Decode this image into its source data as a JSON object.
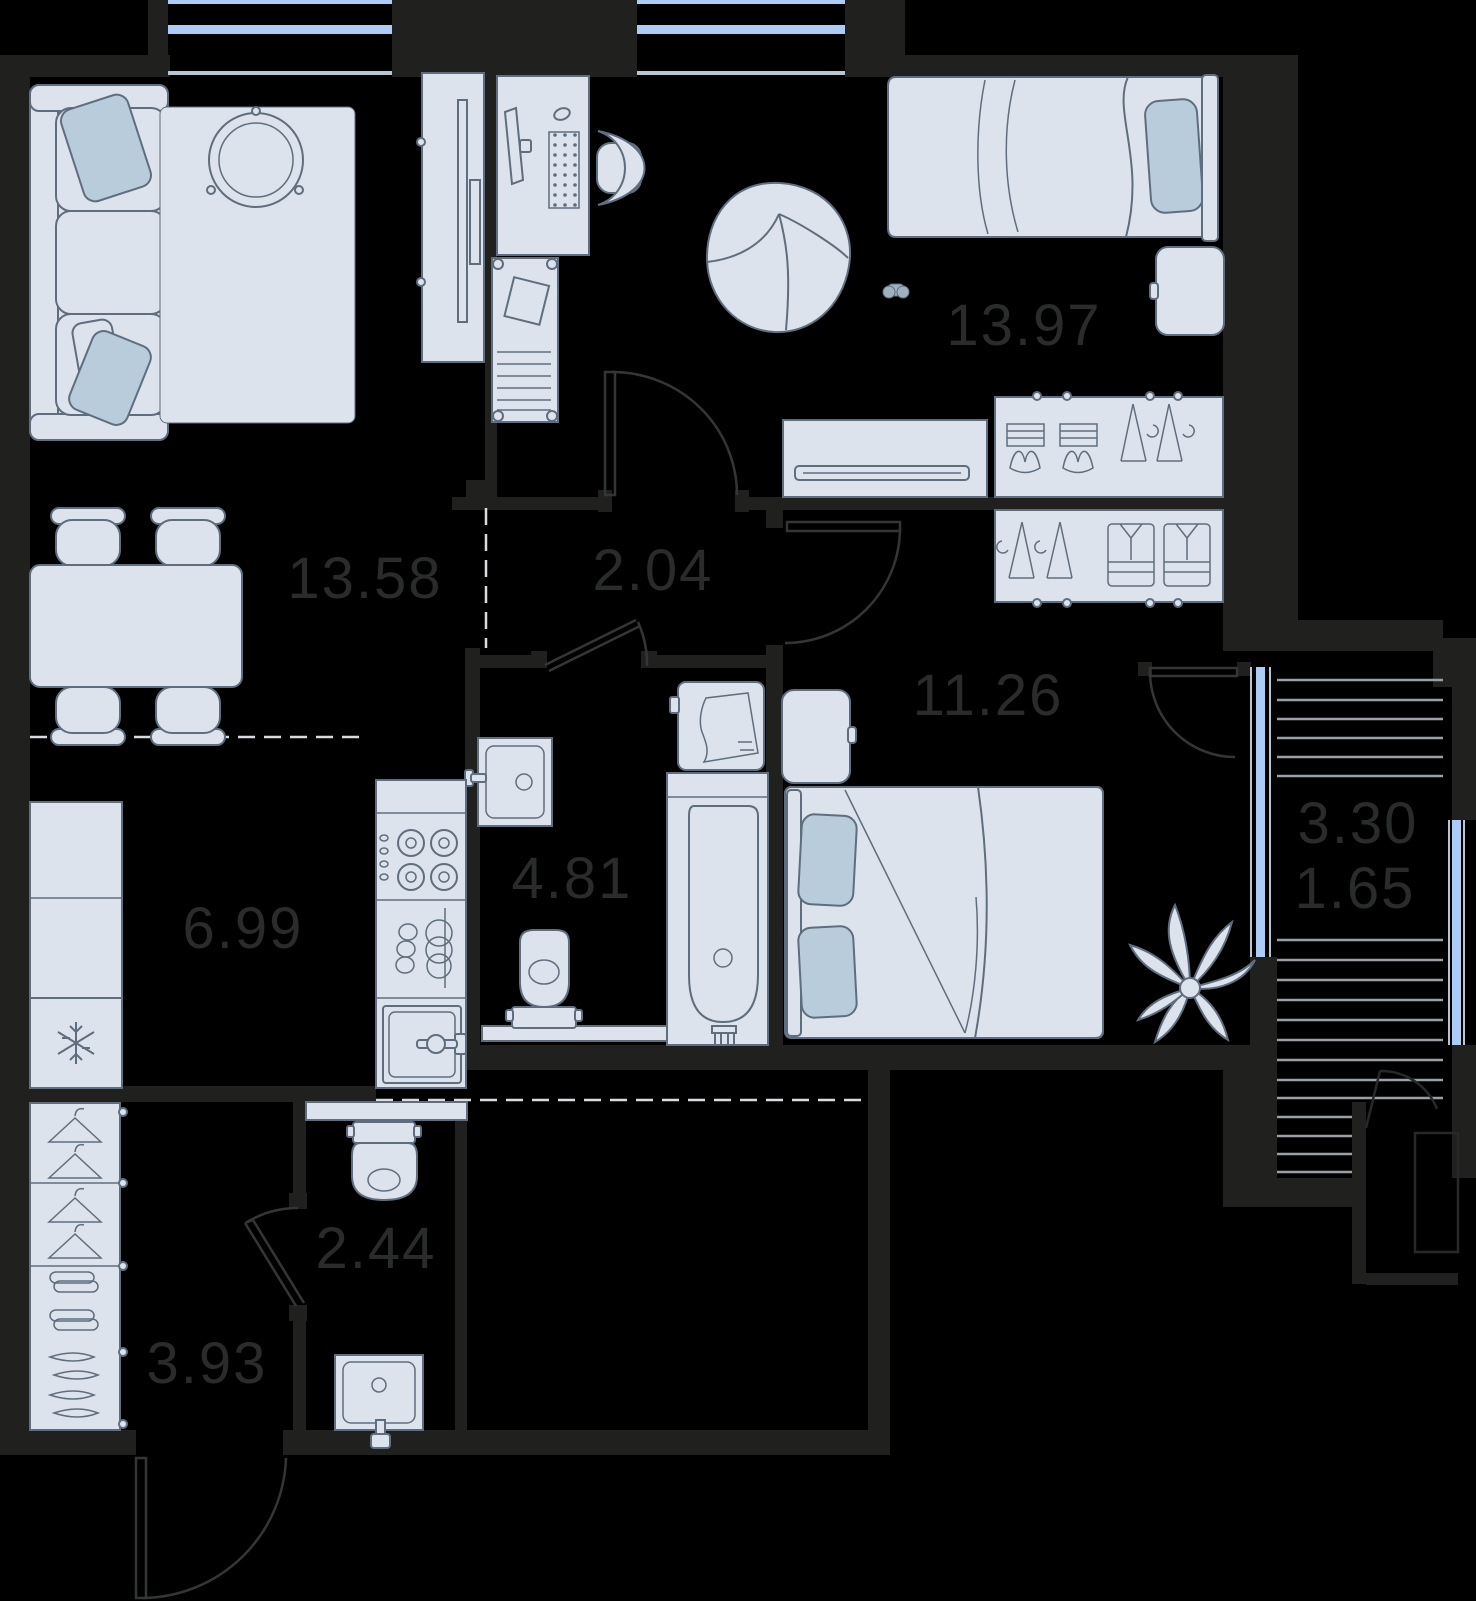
{
  "rooms": {
    "bedroom_top": {
      "area": "13.97"
    },
    "living": {
      "area": "13.58"
    },
    "hall": {
      "area": "2.04"
    },
    "bedroom": {
      "area": "11.26"
    },
    "bathroom": {
      "area": "4.81"
    },
    "kitchen": {
      "area": "6.99"
    },
    "balcony": {
      "area_total": "3.30",
      "area_counted": "1.65"
    },
    "wc": {
      "area": "2.44"
    },
    "entry": {
      "area": "3.93"
    }
  },
  "colors": {
    "background": "#000000",
    "wall": "#20201f",
    "area_label": "#2a2b2b",
    "door_line": "#333637",
    "dashed_line": "#d8dcdf",
    "window_glass": "#accbf5",
    "window_frame": "#bac5d3",
    "balcony_board": "#9aa1a6",
    "furniture_fill": "#dce3ec",
    "furniture_stroke": "#5f6e7e",
    "furniture_soft": "#b9ccdc",
    "faint_line": "#26292a"
  }
}
